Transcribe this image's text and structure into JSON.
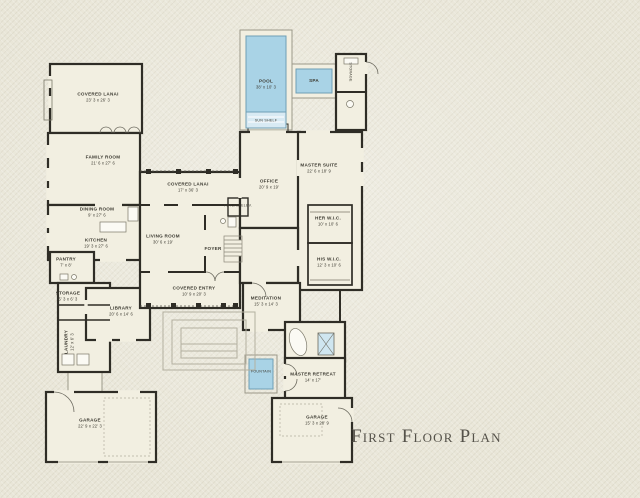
{
  "title": "First Floor Plan",
  "colors": {
    "background": "#e9e6d8",
    "paper": "#f2efe1",
    "wall": "#2f2d26",
    "water": "#a9d3e6",
    "water_light": "#d8eaf3",
    "water_border": "#6f9fb5",
    "shower": "#cfe6f0",
    "title": "#55524a",
    "label": "#3c3a31"
  },
  "rooms": [
    {
      "name": "COVERED LANAI",
      "dims": "23' 3 x 26' 3"
    },
    {
      "name": "FAMILY ROOM",
      "dims": "21' 6 x 27' 6"
    },
    {
      "name": "DINING ROOM",
      "dims": "9' x 27' 6"
    },
    {
      "name": "KITCHEN",
      "dims": "19' 3 x 27' 6"
    },
    {
      "name": "PANTRY",
      "dims": "7' x 8'"
    },
    {
      "name": "COVERED LANAI",
      "dims": "17' x 36' 3"
    },
    {
      "name": "LIVING ROOM",
      "dims": "30' 6 x 19'"
    },
    {
      "name": "OFFICE",
      "dims": "20' 9 x 19'"
    },
    {
      "name": "MASTER SUITE",
      "dims": "22' 6 x 18' 9"
    },
    {
      "name": "HER W.I.C.",
      "dims": "10' x 10' 6"
    },
    {
      "name": "HIS W.I.C.",
      "dims": "12' 3 x 10' 6"
    },
    {
      "name": "POOL",
      "dims": "38' x 10' 3"
    },
    {
      "name": "SPA",
      "dims": ""
    },
    {
      "name": "SUN SHELF",
      "dims": ""
    },
    {
      "name": "STORAGE",
      "dims": ""
    },
    {
      "name": "FUTURE ELEV.",
      "dims": ""
    },
    {
      "name": "FOYER",
      "dims": ""
    },
    {
      "name": "COVERED ENTRY",
      "dims": "10' 9 x 20' 3"
    },
    {
      "name": "LIBRARY",
      "dims": "20' 6 x 14' 6"
    },
    {
      "name": "MEDITATION",
      "dims": "15' 3 x 14' 3"
    },
    {
      "name": "FOUNTAIN",
      "dims": ""
    },
    {
      "name": "MASTER RETREAT",
      "dims": "14' x 17'"
    },
    {
      "name": "GARAGE",
      "dims": "15' 3 x 28' 9"
    },
    {
      "name": "GARAGE",
      "dims": "22' 9 x 22' 3"
    },
    {
      "name": "LAUNDRY",
      "dims": "12' x 6' 3"
    },
    {
      "name": "STORAGE",
      "dims": "5' 3 x 6' 3"
    }
  ]
}
